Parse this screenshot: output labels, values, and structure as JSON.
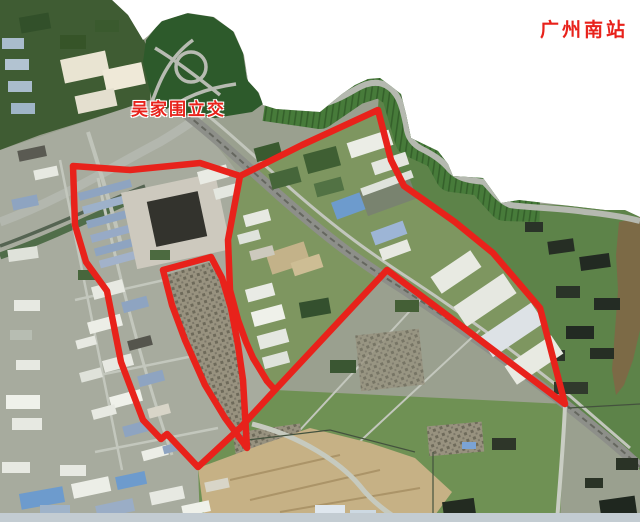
{
  "labels": {
    "station": "广州南站",
    "interchange": "吴家围立交"
  },
  "colors": {
    "annotation_red": "#e8221b",
    "background": "#ffffff"
  },
  "red_overlay": {
    "stroke_width": 6.5,
    "outer_boundary": "73,166 130,170 200,163 240,176 302,145 378,110 391,160 404,186 424,200 455,222 493,253 540,308 565,404 387,270 275,390 240,428 198,467 167,434 161,439 143,420 121,362 107,291 86,262 75,225",
    "north_divider": "240,176 228,240 230,290 238,320 246,342 253,358 267,381 275,390",
    "village_parcel": "163,270 211,257 222,278 231,308 238,345 243,380 247,448 225,418 205,385 185,340 172,305"
  }
}
